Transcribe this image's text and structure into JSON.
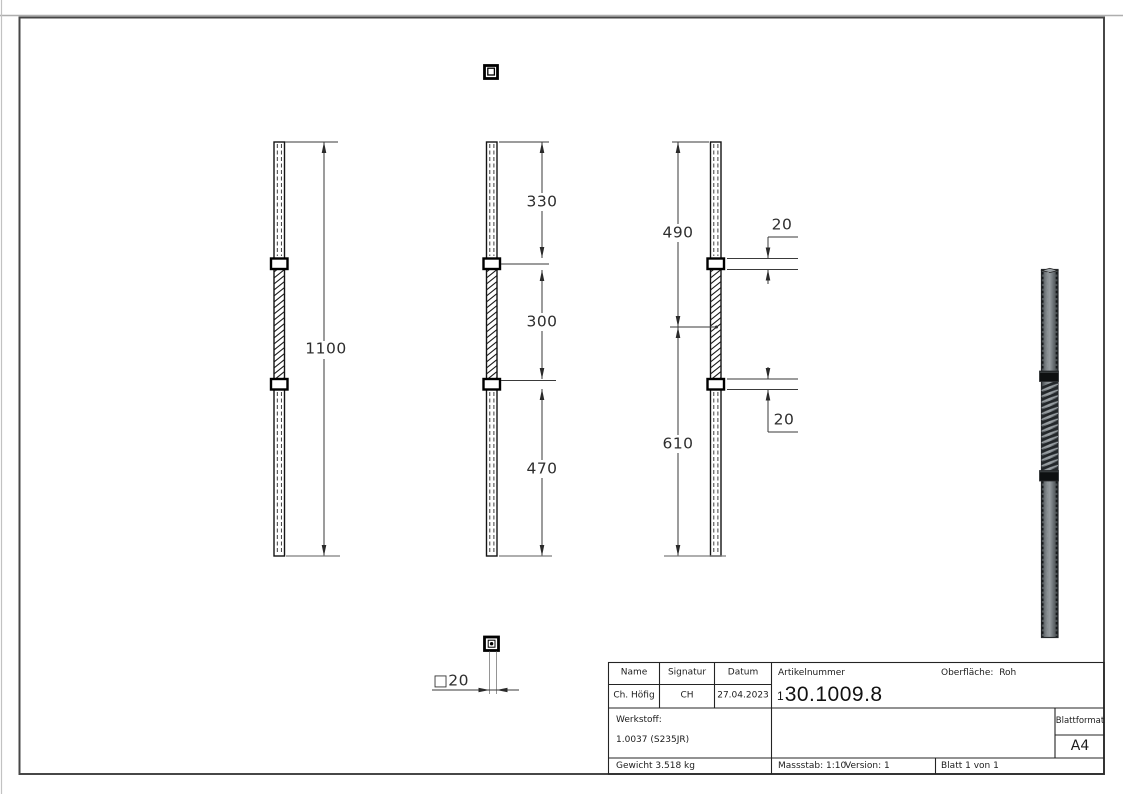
{
  "drawing": {
    "dimensions": {
      "total_length": "1100",
      "segment_top": "330",
      "segment_middle": "300",
      "segment_bottom": "470",
      "upper_to_center": "490",
      "center_to_bottom": "610",
      "collar_upper": "20",
      "collar_lower": "20",
      "profile": "□20"
    }
  },
  "title_block": {
    "name_label": "Name",
    "signatur_label": "Signatur",
    "datum_label": "Datum",
    "name_value": "Ch. Höfig",
    "signatur_value": "CH",
    "datum_value": "27.04.2023",
    "artikelnummer_label": "Artikelnummer",
    "artikelnummer_prefix": "1",
    "artikelnummer_value": "30.1009.8",
    "oberflaeche_label": "Oberfläche:",
    "oberflaeche_value": "Roh",
    "werkstoff_label": "Werkstoff:",
    "werkstoff_value": "1.0037 (S235JR)",
    "gewicht": "Gewicht 3.518 kg",
    "massstab": "Massstab: 1:10",
    "version": "Version: 1",
    "blatt": "Blatt 1 von 1",
    "blattformat_label": "Blattformat",
    "blattformat_value": "A4"
  },
  "colors": {
    "frame": "#4a4a4a",
    "drawing_line": "#3a3a3a",
    "render_body": "#6e7477",
    "render_dark": "#16191b"
  }
}
